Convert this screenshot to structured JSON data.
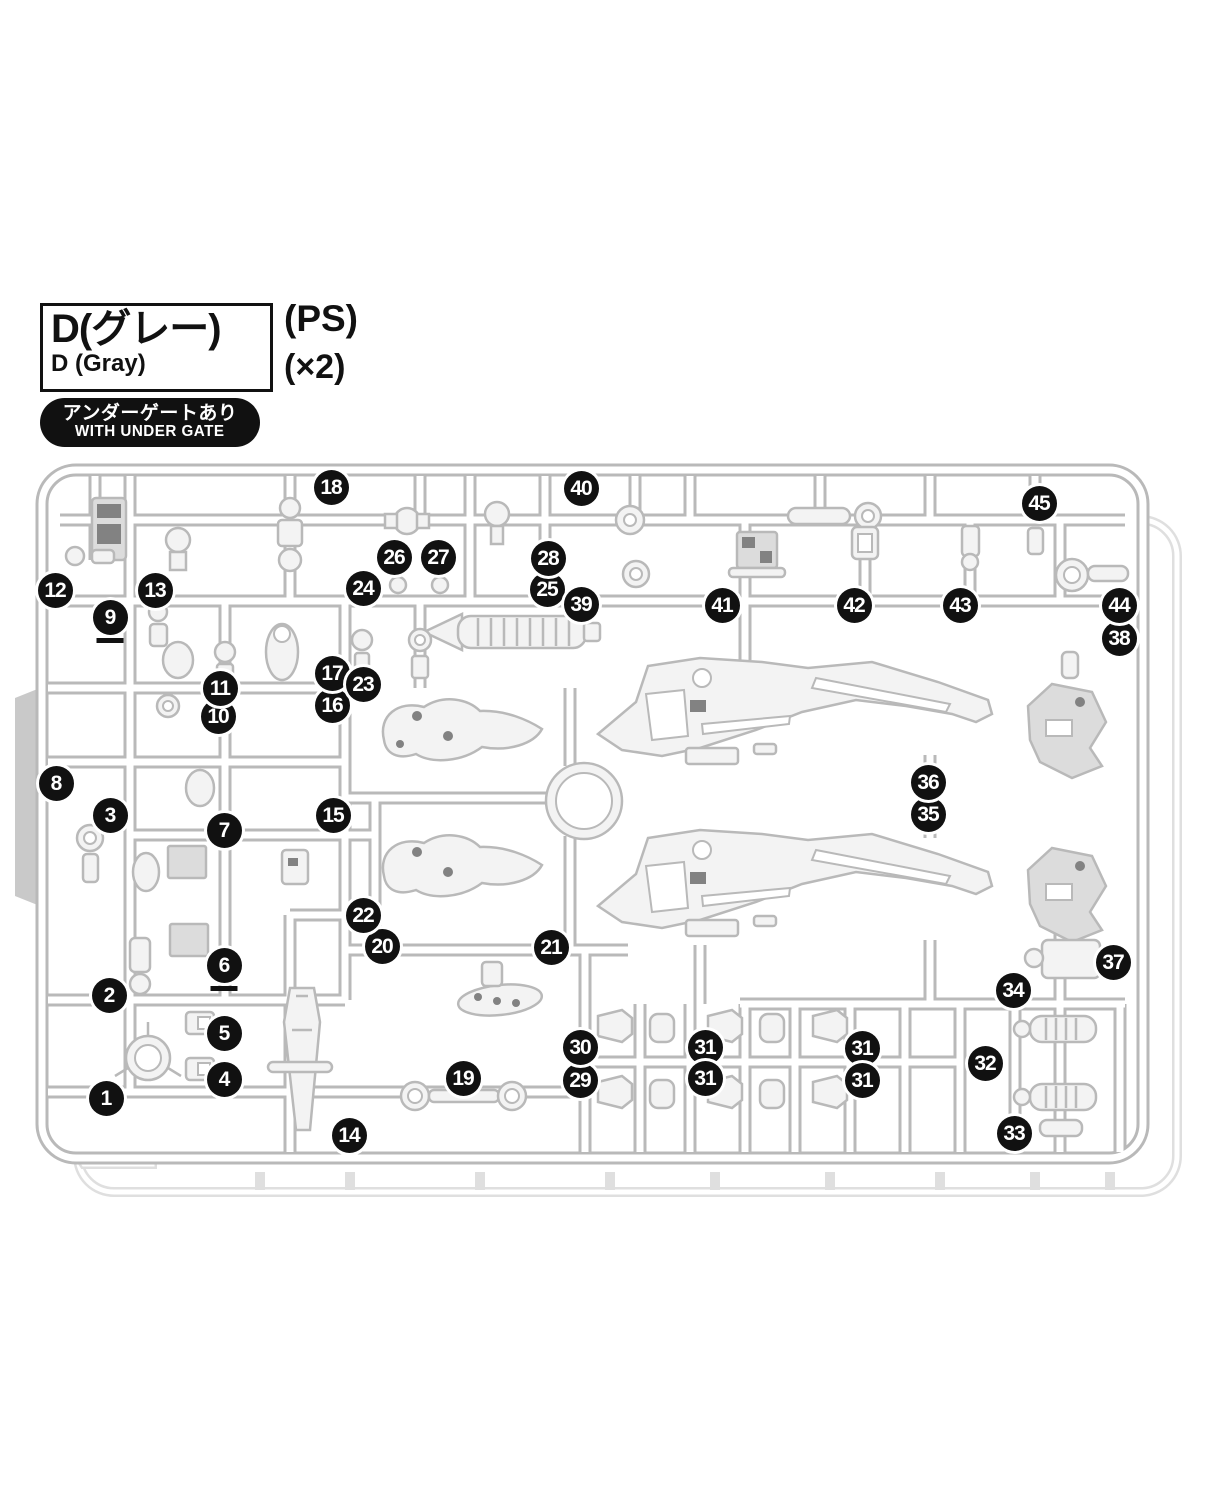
{
  "header": {
    "runner_code_jp": "D(グレー)",
    "runner_code_en": "D (Gray)",
    "material": "(PS)",
    "quantity": "(×2)",
    "badge_jp": "アンダーゲートあり",
    "badge_en": "WITH UNDER GATE"
  },
  "colors": {
    "ink": "#111111",
    "runner": "#b9b9b9",
    "ghost": "#dfdfdf",
    "tab": "#c9c9c9",
    "part-fill": "#f3f3f3",
    "marker-bg": "#111111"
  },
  "sprue": {
    "description": "injection-molded runner D, gray polystyrene, two copies, with under gates",
    "markers": [
      {
        "n": "1",
        "x": 106,
        "y": 1098
      },
      {
        "n": "2",
        "x": 109,
        "y": 995
      },
      {
        "n": "3",
        "x": 110,
        "y": 815
      },
      {
        "n": "4",
        "x": 224,
        "y": 1079
      },
      {
        "n": "5",
        "x": 224,
        "y": 1033
      },
      {
        "n": "6",
        "x": 224,
        "y": 965,
        "underline": true
      },
      {
        "n": "7",
        "x": 224,
        "y": 830
      },
      {
        "n": "8",
        "x": 56,
        "y": 783
      },
      {
        "n": "9",
        "x": 110,
        "y": 617,
        "underline": true
      },
      {
        "n": "10",
        "x": 218,
        "y": 716
      },
      {
        "n": "11",
        "x": 220,
        "y": 688
      },
      {
        "n": "12",
        "x": 55,
        "y": 590
      },
      {
        "n": "13",
        "x": 155,
        "y": 590
      },
      {
        "n": "14",
        "x": 349,
        "y": 1135
      },
      {
        "n": "15",
        "x": 333,
        "y": 815
      },
      {
        "n": "16",
        "x": 332,
        "y": 705
      },
      {
        "n": "17",
        "x": 332,
        "y": 673
      },
      {
        "n": "18",
        "x": 331,
        "y": 487
      },
      {
        "n": "19",
        "x": 463,
        "y": 1078
      },
      {
        "n": "20",
        "x": 382,
        "y": 946
      },
      {
        "n": "21",
        "x": 551,
        "y": 947
      },
      {
        "n": "22",
        "x": 363,
        "y": 915
      },
      {
        "n": "23",
        "x": 363,
        "y": 684
      },
      {
        "n": "24",
        "x": 363,
        "y": 588
      },
      {
        "n": "25",
        "x": 547,
        "y": 589
      },
      {
        "n": "26",
        "x": 394,
        "y": 557
      },
      {
        "n": "27",
        "x": 438,
        "y": 557
      },
      {
        "n": "28",
        "x": 548,
        "y": 558
      },
      {
        "n": "29",
        "x": 580,
        "y": 1080
      },
      {
        "n": "30",
        "x": 580,
        "y": 1047
      },
      {
        "n": "31",
        "x": 705,
        "y": 1047
      },
      {
        "n": "31",
        "x": 705,
        "y": 1078
      },
      {
        "n": "31",
        "x": 862,
        "y": 1048
      },
      {
        "n": "31",
        "x": 862,
        "y": 1080
      },
      {
        "n": "32",
        "x": 985,
        "y": 1063
      },
      {
        "n": "33",
        "x": 1014,
        "y": 1133
      },
      {
        "n": "34",
        "x": 1013,
        "y": 990
      },
      {
        "n": "35",
        "x": 928,
        "y": 814
      },
      {
        "n": "36",
        "x": 928,
        "y": 782
      },
      {
        "n": "37",
        "x": 1113,
        "y": 962
      },
      {
        "n": "38",
        "x": 1119,
        "y": 638
      },
      {
        "n": "39",
        "x": 581,
        "y": 604
      },
      {
        "n": "40",
        "x": 581,
        "y": 488
      },
      {
        "n": "41",
        "x": 722,
        "y": 605
      },
      {
        "n": "42",
        "x": 854,
        "y": 605
      },
      {
        "n": "43",
        "x": 960,
        "y": 605
      },
      {
        "n": "44",
        "x": 1119,
        "y": 605
      },
      {
        "n": "45",
        "x": 1039,
        "y": 503
      }
    ]
  }
}
